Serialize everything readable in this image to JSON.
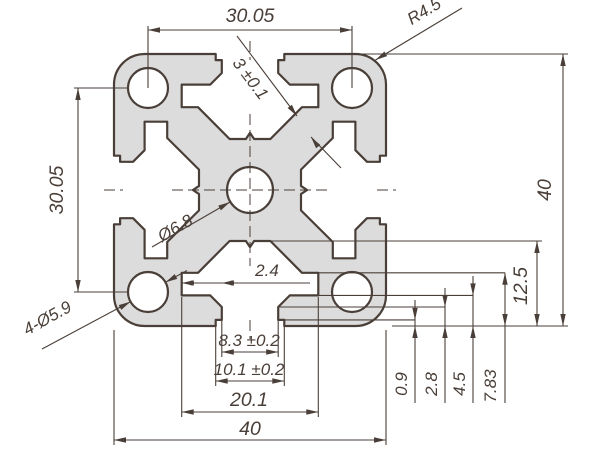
{
  "drawing": {
    "colors": {
      "line": "#4a3f38",
      "fill": "#dcdcdc",
      "background": "#ffffff"
    },
    "dims": {
      "top_hole_spacing": "30.05",
      "left_hole_spacing": "30.05",
      "corner_radius": "R4.5",
      "web_thickness": "3 ±0.1",
      "center_hole": "Ø6.8",
      "corner_holes": "4-Ø5.9",
      "step_width": "2.4",
      "slot_opening": "8.3 ±0.2",
      "slot_mouth": "10.1 ±0.2",
      "cavity_width": "20.1",
      "overall_width": "40",
      "overall_height": "40",
      "slot_depth": "12.5",
      "lip_recess_depth": "0.9",
      "lip_depth": "2.8",
      "lip_root_depth": "4.5",
      "step_depth": "7.83"
    }
  }
}
